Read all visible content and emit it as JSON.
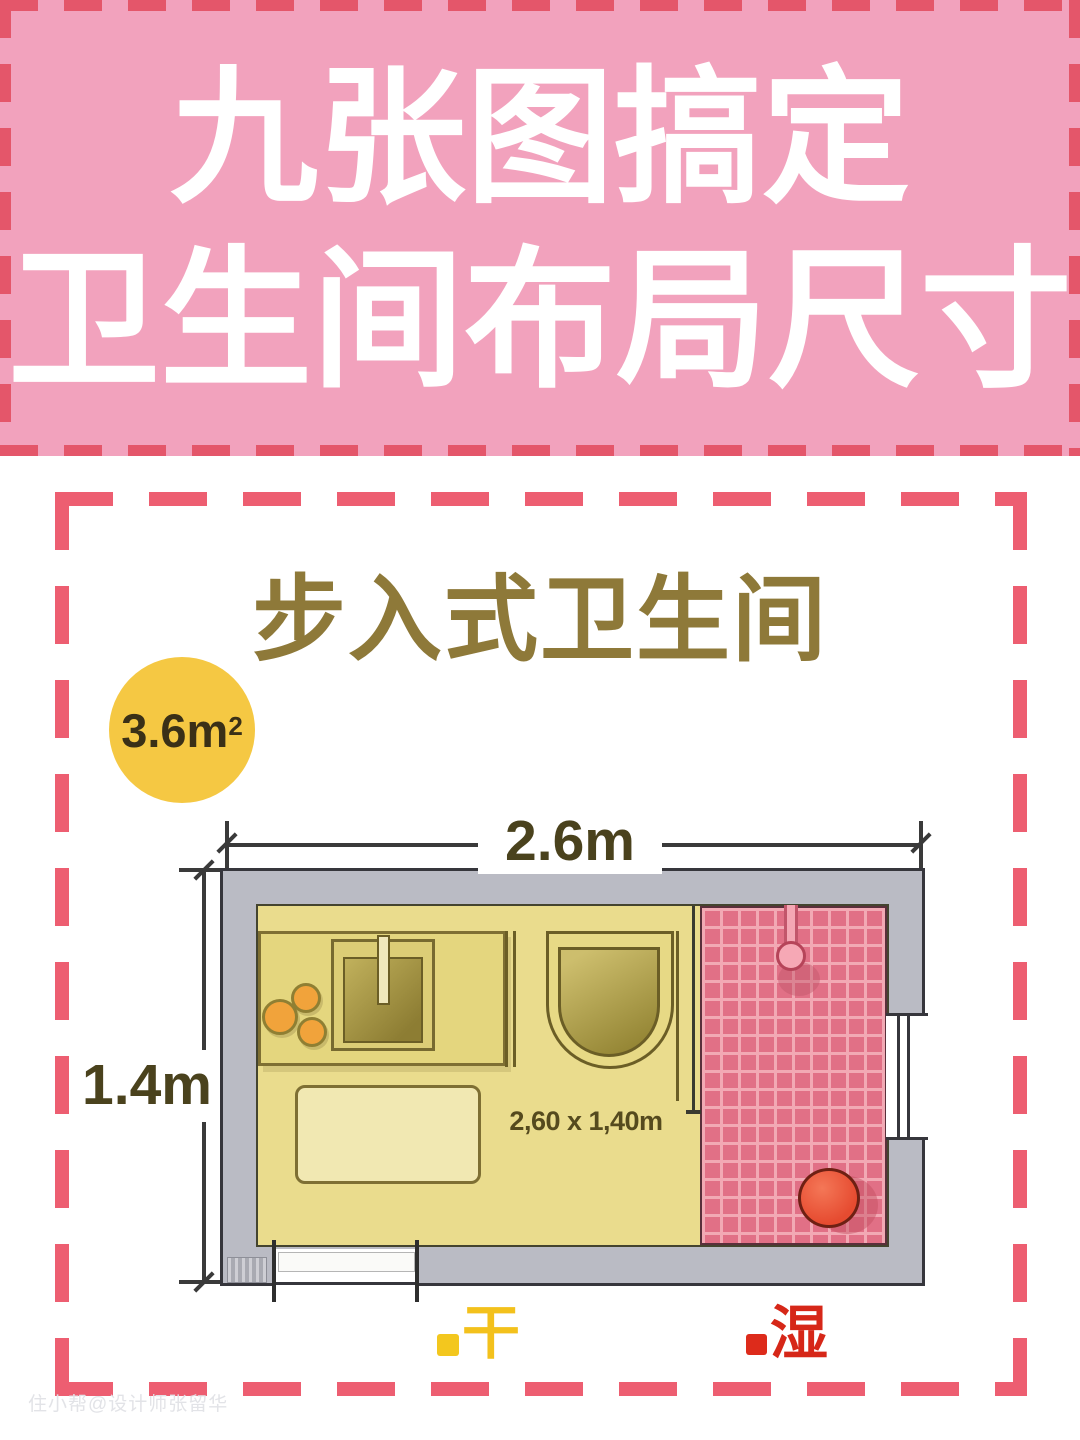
{
  "banner": {
    "line1": "九张图搞定",
    "line2": "卫生间布局尺寸",
    "bg_color": "#F2A2BD",
    "dash_color": "#E4566A",
    "text_color": "#FFFFFF"
  },
  "card": {
    "frame_dash_color": "#ED5E71",
    "title": "步入式卫生间",
    "title_color": "#8E7939",
    "area_badge": {
      "value": "3.6m",
      "sup": "2",
      "bg_color": "#F5C843",
      "text_color": "#3A3017"
    },
    "plan": {
      "width_label": "2.6m",
      "height_label": "1.4m",
      "size_label": "2,60 x 1,40m",
      "dim_text_color": "#4A421D",
      "wall_color": "#B9BAC3",
      "dry_floor_color": "#EADC8D",
      "wet_tile_color": "#E17086",
      "stool_color": "#E64B30",
      "fixtures": [
        "counter",
        "sink",
        "faucet",
        "toilet",
        "rug",
        "shower-head",
        "stool",
        "window",
        "door",
        "glass-partition"
      ]
    },
    "legend": {
      "dry_label": "干",
      "dry_color": "#F3C11C",
      "wet_label": "湿",
      "wet_color": "#D62718"
    }
  },
  "watermark": "住小帮@设计师张留华"
}
